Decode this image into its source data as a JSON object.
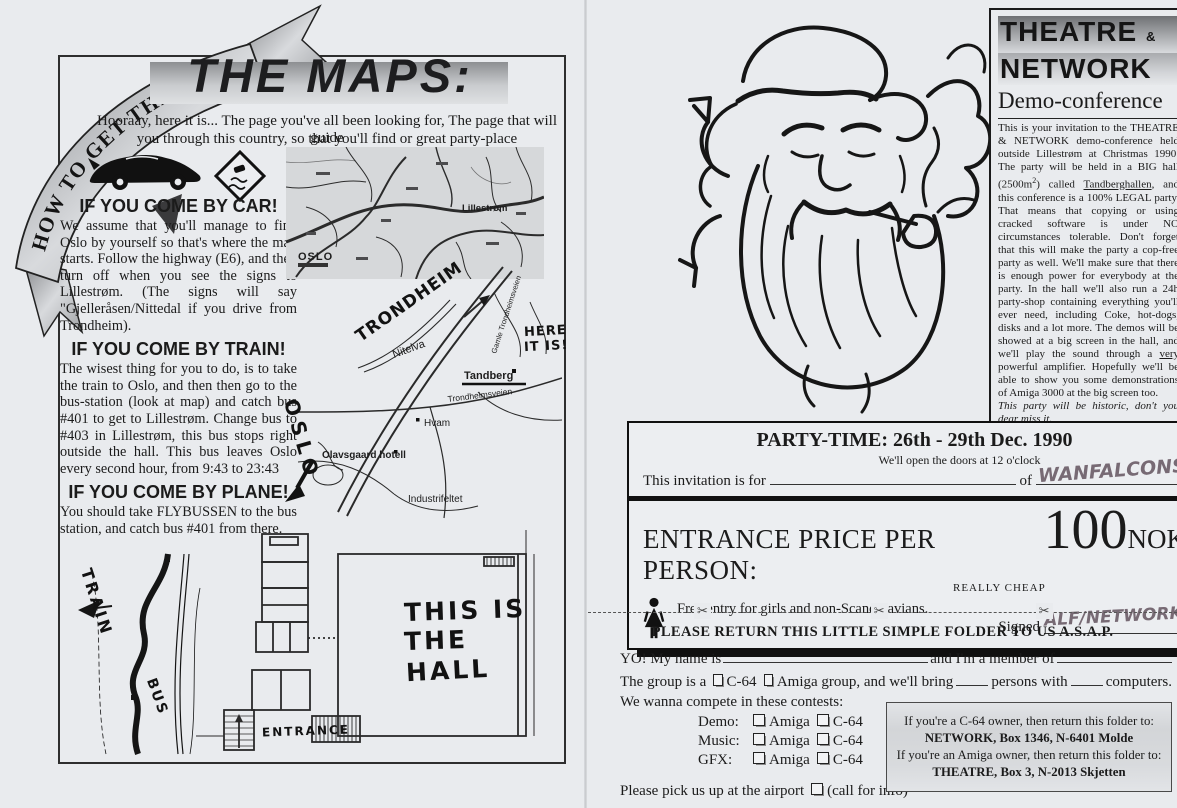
{
  "scan": {
    "ribbon": "HOW TO GET THERE!",
    "left": {
      "title": "THE MAPS:",
      "intro1": "Hooraay, here it is... The page you've all been looking for, The page that will guide",
      "intro2": "you through this country, so that you'll find or great party-place",
      "car_heading": "IF YOU COME BY CAR!",
      "car_body": "We assume that you'll manage to find Oslo by yourself so that's where the map starts. Follow the highway (E6), and then turn off when you see the signs to Lillestrøm. (The signs will say \"Gjelleråsen/Nittedal if you drive from Trondheim).",
      "train_heading": "IF YOU COME BY TRAIN!",
      "train_body": "The wisest thing for you to do, is to take the train to Oslo, and then then go to the bus-station (look at map) and catch bus #401 to get to Lillestrøm. Change bus to #403 in Lillestrøm, this bus stops right outside the hall. This bus leaves Oslo every second hour, from 9:43 to 23:43",
      "plane_heading": "IF YOU COME BY PLANE!",
      "plane_body": "You should take FLYBUSSEN to the bus station, and catch  bus #401 from there.",
      "road_map": {
        "oslo": "OSLO",
        "lillestrom": "Lillestrøm"
      },
      "sketch_map": {
        "trondheim": "TRONDHEIM",
        "nitelva": "Nitelva",
        "tandberg": "Tandberg",
        "here1": "HERE",
        "here2": "IT IS!",
        "hvam": "Hvam",
        "hotel": "Olavsgaard hotell",
        "road": "Trondheimsveien",
        "old_road": "Gamle Trondheimsveien",
        "industri": "Industrifeltet",
        "oslo": "OSLO"
      },
      "train_map": {
        "train": "TRAIN",
        "bus": "BUS"
      },
      "floor_plan": {
        "hall1": "THIS IS",
        "hall2": "THE",
        "hall3": "HALL",
        "entrance": "ENTRANCE"
      }
    },
    "right": {
      "header": {
        "title1": "THEATRE",
        "amp": "&",
        "title2": "NETWORK",
        "subtitle": "Demo-conference",
        "p1": "This is your invitation to the THEATRE & NETWORK demo-conference held outside Lillestrøm at Christmas 1990. The party will be held in a BIG hall (2500m",
        "sup": "2",
        "p2": ") called ",
        "u1": "Tandberghallen",
        "p3": ", and this conference is a 100% LEGAL party. That means that copying or using cracked software is under NO circumstances tolerable. Don't forget that this will make the party a cop-free party as well. We'll make sure that there is enough power for everybody at the party. In the hall we'll also run a 24h party-shop containing everything you'll ever need, including Coke, hot-dogs, disks and a lot more.  The demos  will be showed at a big screen in the hall, and we'll play the sound through a ",
        "u2": "very",
        "p4": " powerful amplifier. Hopefully we'll be able to show you some demonstrations of Amiga 3000 at the big screen too.",
        "italic_line": "This party will be historic, don't you dear miss it.",
        "bold_line": "Enjoy the party, and have fun!!"
      },
      "party_box": {
        "title": "PARTY-TIME: 26th - 29th Dec. 1990",
        "doors": "We'll open the doors at 12 o'clock",
        "invite_label": "This invitation is for",
        "of_label": "of",
        "invitee": "WANFALCONS",
        "price_label": "ENTRANCE PRICE PER PERSON:",
        "price_value": "100",
        "price_currency": "NOK",
        "price_note": "REALLY CHEAP",
        "free_entry": "Free entry for girls and non-Scandinavians.",
        "signed_label": "Signed",
        "signature": "ALF/NETWORK"
      },
      "scissors": "✂",
      "cut_note": "PLEASE RETURN THIS LITTLE SIMPLE FOLDER TO US A.S.A.P.",
      "form": {
        "l1a": "YO! My name is",
        "l1b": "and I'm a member of",
        "l2a": "The group is a",
        "l2b": "C-64",
        "l2c": "Amiga group, and we'll bring",
        "l2d": "persons with",
        "l2e": "computers.",
        "l3": "We wanna compete in these contests:",
        "contests": [
          {
            "label": "Demo:",
            "opt1": "Amiga",
            "opt2": "C-64"
          },
          {
            "label": "Music:",
            "opt1": "Amiga",
            "opt2": "C-64"
          },
          {
            "label": "GFX:",
            "opt1": "Amiga",
            "opt2": "C-64"
          }
        ],
        "airport_a": "Please pick us up at the airport",
        "airport_b": "(call for info)",
        "arrive_a": "We'll arrive",
        "arrive_b": "day",
        "arrive_c": "th Dec. 1990"
      },
      "address_box": {
        "c64_line": "If you're a C-64 owner, then return this folder to:",
        "c64_addr": "NETWORK, Box 1346, N-6401 Molde",
        "amiga_line": "If you're an Amiga owner, then return this folder to:",
        "amiga_addr": "THEATRE, Box 3, N-2013 Skjetten"
      }
    }
  }
}
